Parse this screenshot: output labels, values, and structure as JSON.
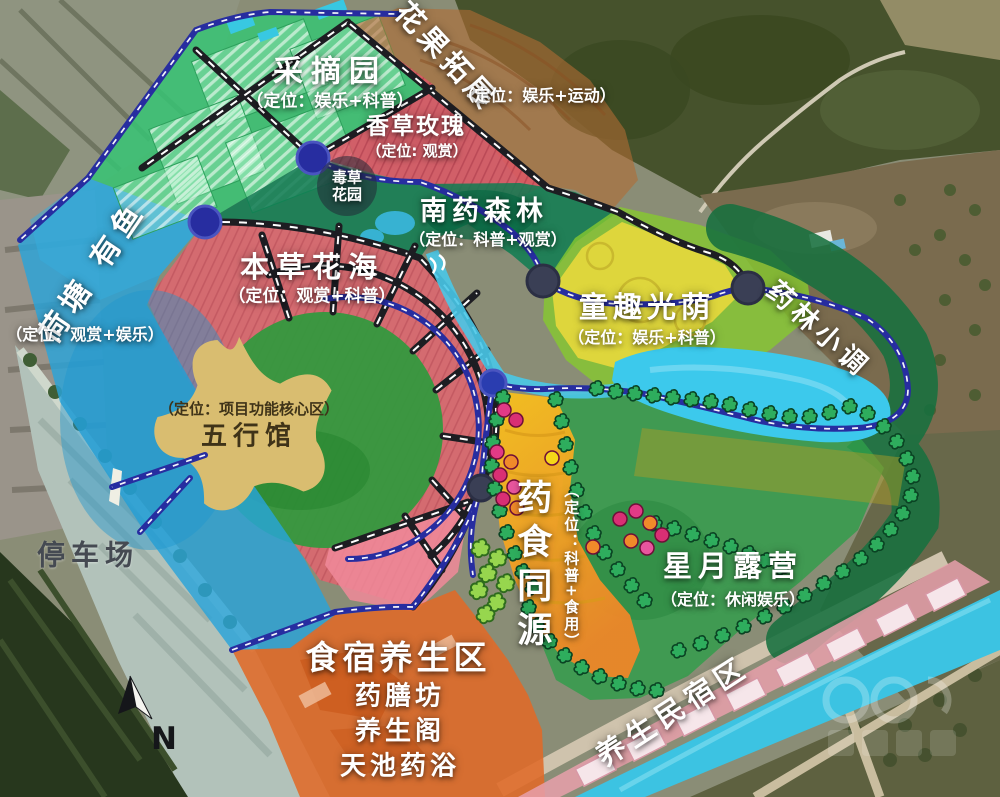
{
  "zones": {
    "picking_garden": {
      "title": "采摘园",
      "subtitle": "（定位：娱乐+科普）"
    },
    "flower_fruit_expansion": {
      "title": "花果拓展",
      "subtitle": "（定位：娱乐+运动）"
    },
    "vanilla_rose": {
      "title": "香草玫瑰",
      "subtitle": "（定位: 观赏）"
    },
    "poison_herb_garden": {
      "line1": "毒草",
      "line2": "花园"
    },
    "south_medicine_forest": {
      "title": "南药森林",
      "subtitle": "（定位：科普+观赏）"
    },
    "lotus_pond": {
      "title": "荷塘 有鱼",
      "subtitle": "（定位：观赏+娱乐）"
    },
    "herb_flower_sea": {
      "title": "本草花海",
      "subtitle": "（定位：观赏+科普）"
    },
    "childhood_light": {
      "title": "童趣光荫",
      "subtitle": "（定位：娱乐+科普）"
    },
    "medicine_forest_melody": {
      "title": "药林小调"
    },
    "five_elements_hall": {
      "title": "五行馆",
      "subtitle": "（定位：项目功能核心区）"
    },
    "parking_lot": {
      "title": "停车场"
    },
    "medicine_food_origin": {
      "title": "药食同源",
      "subtitle": "（定位：科普+食用）"
    },
    "star_moon_camping": {
      "title": "星月露营",
      "subtitle": "（定位：休闲娱乐）"
    },
    "dining_wellness": {
      "title": "食宿养生区",
      "items": [
        "药膳坊",
        "养生阁",
        "天池药浴"
      ]
    },
    "wellness_homestay": {
      "title": "养生民宿区"
    }
  },
  "compass": {
    "letter": "N"
  },
  "colors": {
    "picking_garden": "#37c474",
    "vanilla_rose": "#e05565",
    "flower_fruit": "#b06c34",
    "south_forest": "#0e7d52",
    "lotus_pond": "#2aa3d9",
    "flower_sea": "#e06570",
    "core_circle": "#2f9a3d",
    "star": "#d9bd70",
    "childhood": "#e8d83c",
    "melody_band": "#17703f",
    "pond": "#3cc9ec",
    "medicine_food": "#f6c11d",
    "camping": "#2f9e4a",
    "dining": "#e06a28",
    "homestay": "#e8a0ac",
    "river": "#3cc3e2",
    "road_black": "#1d1d22",
    "path_blue": "#272da0"
  }
}
